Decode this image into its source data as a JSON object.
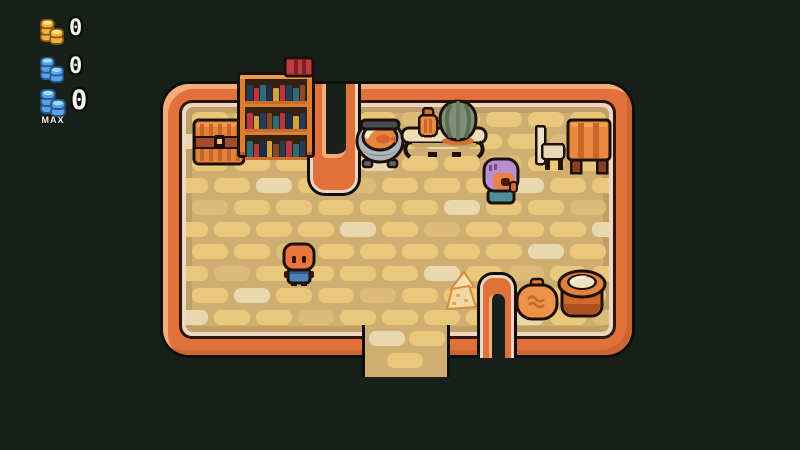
{
  "hud": {
    "rows": [
      {
        "name": "gold-coin-counter",
        "icon": "gold-coin-stack-icon",
        "value": "0"
      },
      {
        "name": "blue-coin-counter",
        "icon": "blue-coin-stack-icon",
        "value": "0"
      },
      {
        "name": "blue-coin-counter-max",
        "icon": "blue-coin-stack-icon",
        "value": "0",
        "badge": "MAX"
      }
    ]
  },
  "colors": {
    "background": "#17201b",
    "wall_orange": "#e0713a",
    "wall_highlight": "#f3ac7a",
    "wall_inner_line": "#2e150c",
    "wall_inner_trim": "#eed6c3",
    "floor_base": "#cfae72",
    "tile_yellow": "#e9c77b",
    "tile_pale": "#e9d8ad",
    "tile_muted": "#ddbb79",
    "coin_gold": "#f1b33d",
    "coin_blue": "#57a3e8",
    "player_skin": "#e8753d",
    "player_shirt": "#4d80b8",
    "npc_hair": "#b98fd2",
    "npc_shirt": "#4f8d99"
  },
  "bookshelf": {
    "rows": [
      [
        "#233d5a",
        "#b93642",
        "#2c6d7c",
        "#172f49",
        "#d3a33f",
        "#b93642",
        "#233d5a",
        "#2c6d7c",
        "#8a482a"
      ],
      [
        "#b93642",
        "#d3a33f",
        "#233d5a",
        "#8a482a",
        "#2c6d7c",
        "#b93642",
        "#172f49",
        "#d3a33f",
        "#233d5a"
      ],
      [
        "#2c6d7c",
        "#b93642",
        "#172f49",
        "#d3a33f",
        "#8a482a",
        "#233d5a",
        "#b93642",
        "#2c6d7c",
        "#233d5a"
      ]
    ]
  },
  "scene": {
    "objects": [
      "treasure-chest",
      "bookshelf",
      "red-book-stack",
      "fish-cauldron",
      "long-table",
      "potted-plant",
      "rock-succulent",
      "chair",
      "side-table",
      "npc-purple-hair",
      "player-character",
      "hay-pile",
      "grain-sack",
      "clay-pot",
      "exit-south",
      "wall-peninsula-north",
      "wall-notch-south"
    ]
  }
}
